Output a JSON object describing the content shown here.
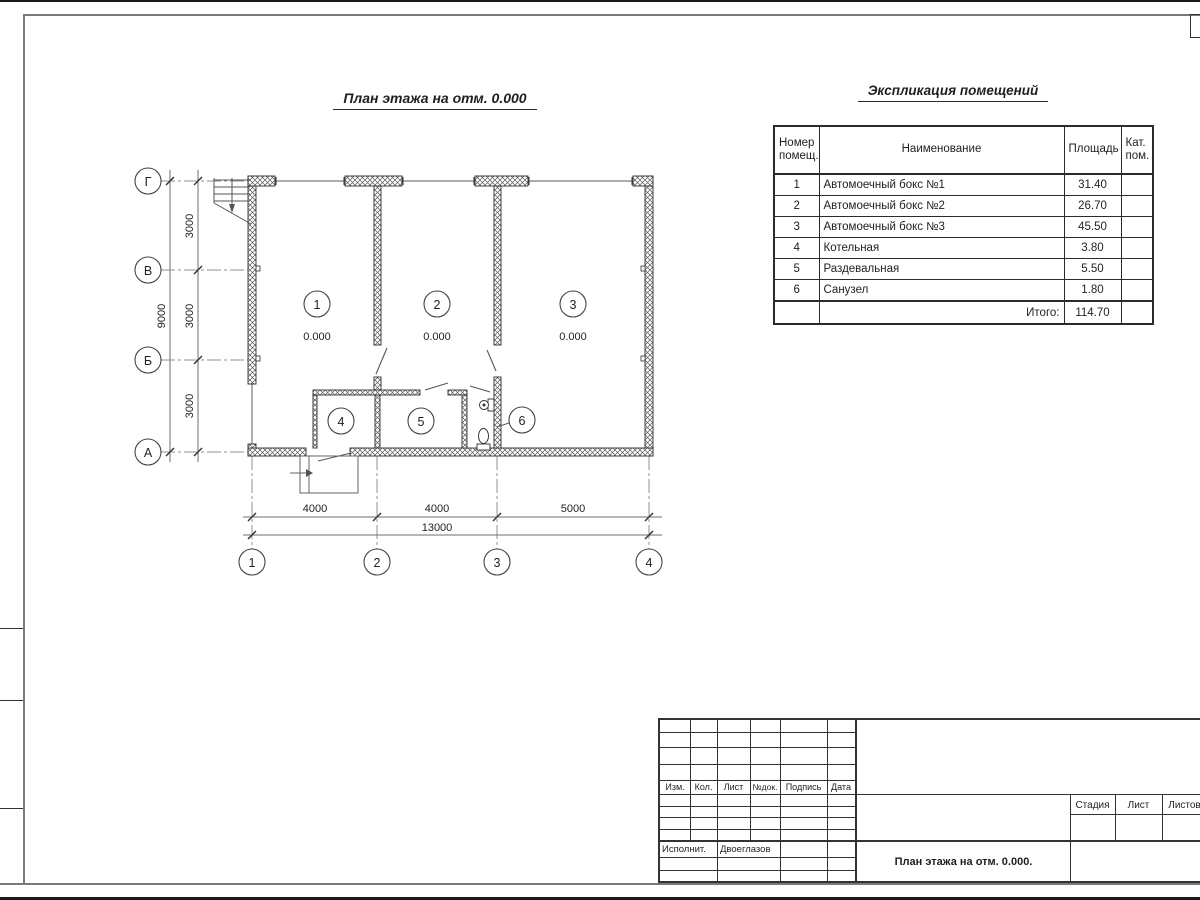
{
  "drawing": {
    "plan_title": "План этажа на отм. 0.000",
    "row_axes": [
      "Г",
      "В",
      "Б",
      "А"
    ],
    "col_axes": [
      "1",
      "2",
      "3",
      "4"
    ],
    "room_numbers": [
      "1",
      "2",
      "3",
      "4",
      "5",
      "6"
    ],
    "elevations": [
      "0.000",
      "0.000",
      "0.000"
    ],
    "dims_left": [
      "3000",
      "3000",
      "3000"
    ],
    "dims_left_total": "9000",
    "dims_bottom": [
      "4000",
      "4000",
      "5000"
    ],
    "dims_bottom_total": "13000"
  },
  "schedule": {
    "title": "Экспликация помещений",
    "headers": {
      "number": "Номер помещ.",
      "name": "Наименование",
      "area": "Площадь",
      "category": "Кат. пом."
    },
    "rows": [
      {
        "num": "1",
        "name": "Автомоечный бокс №1",
        "area": "31.40",
        "cat": ""
      },
      {
        "num": "2",
        "name": "Автомоечный бокс №2",
        "area": "26.70",
        "cat": ""
      },
      {
        "num": "3",
        "name": "Автомоечный бокс №3",
        "area": "45.50",
        "cat": ""
      },
      {
        "num": "4",
        "name": "Котельная",
        "area": "3.80",
        "cat": ""
      },
      {
        "num": "5",
        "name": "Раздевальная",
        "area": "5.50",
        "cat": ""
      },
      {
        "num": "6",
        "name": "Санузел",
        "area": "1.80",
        "cat": ""
      }
    ],
    "total_label": "Итого:",
    "total_value": "114.70"
  },
  "title_block": {
    "change_cols": [
      "Изм.",
      "Кол.",
      "Лист",
      "№док.",
      "Подпись",
      "Дата"
    ],
    "executor_label": "Исполнит.",
    "executor_name": "Двоеглазов",
    "doc_title": "План этажа на отм. 0.000.",
    "stage_label": "Стадия",
    "sheet_label": "Лист",
    "sheets_label": "Листов"
  },
  "colors": {
    "line": "#333333",
    "thin_line": "#777777",
    "text": "#1f1f1f",
    "background": "#ffffff"
  }
}
